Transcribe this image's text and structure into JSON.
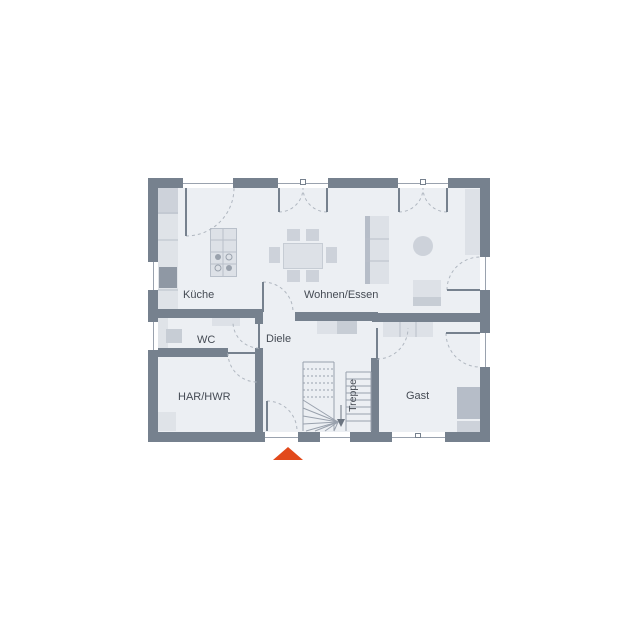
{
  "plan": {
    "rooms": [
      {
        "id": "kueche",
        "label": "Küche"
      },
      {
        "id": "wohnen_essen",
        "label": "Wohnen/Essen"
      },
      {
        "id": "wc",
        "label": "WC"
      },
      {
        "id": "diele",
        "label": "Diele"
      },
      {
        "id": "har_hwr",
        "label": "HAR/HWR"
      },
      {
        "id": "treppe",
        "label": "Treppe"
      },
      {
        "id": "gast",
        "label": "Gast"
      }
    ],
    "entrance_marker": {
      "icon": "triangle-up-icon",
      "color": "#e2491b"
    },
    "colors": {
      "wall": "#76818e",
      "floor": "#eceff3",
      "furniture_light": "#dde1e7",
      "furniture_dark": "#b6bdc8",
      "door_arc": "#b0b7c0",
      "accent": "#e2491b",
      "label_text": "#454b54"
    }
  }
}
